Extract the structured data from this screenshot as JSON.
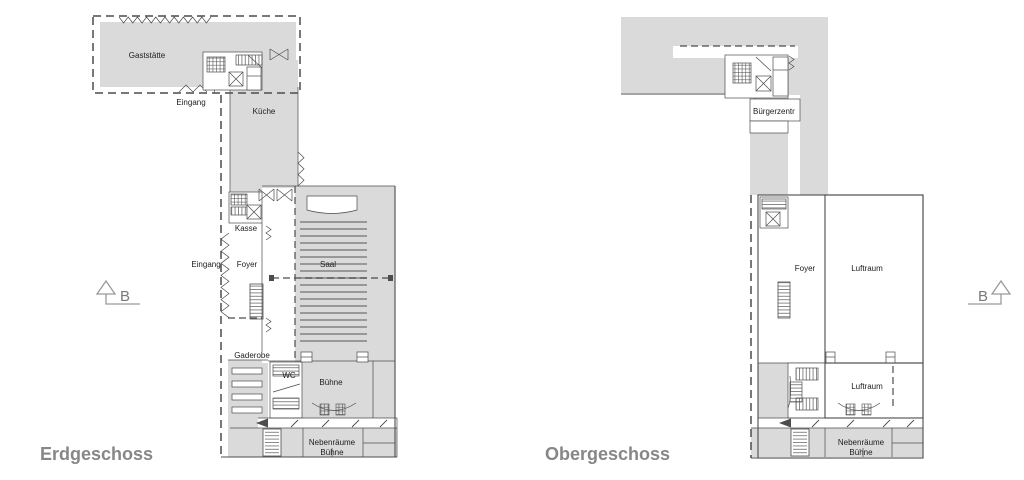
{
  "colors": {
    "room_fill": "#dadada",
    "line": "#4c4c4c",
    "label": "#1c1c1c",
    "title": "#878787"
  },
  "erdgeschoss": {
    "title": "Erdgeschoss",
    "section_marker": "B",
    "labels": {
      "gaststaette": "Gaststätte",
      "eingang_top": "Eingang",
      "kueche": "Küche",
      "kasse": "Kasse",
      "eingang_side": "Eingang",
      "foyer": "Foyer",
      "saal": "Saal",
      "garderobe": "Gaderobe",
      "wc": "WC",
      "buehne": "Bühne",
      "nebenraeume_line1": "Nebenräume",
      "nebenraeume_line2": "Bühne"
    }
  },
  "obergeschoss": {
    "title": "Obergeschoss",
    "section_marker": "B",
    "labels": {
      "buergerzentrum": "Bürgerzentr",
      "foyer": "Foyer",
      "luftraum_ueber_saal": "Luftraum",
      "luftraum_ueber_buehne": "Luftraum",
      "nebenraeume_line1": "Nebenräume",
      "nebenraeume_line2": "Bühne"
    }
  }
}
